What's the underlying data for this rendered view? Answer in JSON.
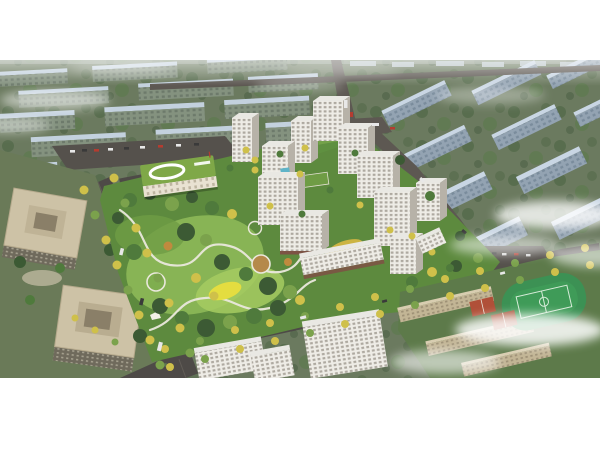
{
  "image": {
    "kind": "aerial-architectural-rendering",
    "regions": [
      "background-building-rows",
      "mist-clouds",
      "residential-tower-cluster",
      "central-park",
      "kindergarten-building",
      "office-towers",
      "school-campus",
      "sports-field",
      "tree-lined-boulevards",
      "roads"
    ]
  },
  "colors": {
    "ground": "#6b7a5f",
    "ground_dark": "#55654c",
    "bg_slab_top": "#c3d1de",
    "bg_slab_top_r": "#c9d6e4",
    "bg_slab_face": "#84927f",
    "bg_slab_face_r": "#93a3b2",
    "tree_dark": "#3c5a34",
    "tree_mid": "#4f7a3c",
    "tree_light": "#7ba24c",
    "tree_yellow": "#cfc04a",
    "tree_orange": "#c08a3e",
    "road": "#4e4a47",
    "road_light": "#5d5852",
    "path_white": "#eae8dc",
    "park_base": "#5d8a3e",
    "lawn_light": "#8db858",
    "lawn_bright": "#a6cb62",
    "feature_yellow": "#e4dd40",
    "tower_face": "#eeece6",
    "tower_side": "#b7b2a8",
    "tower_roof": "#e9e8e3",
    "tower_win": "#9d988e",
    "kg_roof": "#7fa848",
    "kg_face": "#e9e2d2",
    "office_tan": "#cdc2a6",
    "school_tan": "#c2b595",
    "field_green": "#3f9b58",
    "court_red": "#b05038",
    "pool_blue": "#5fb4c8",
    "storefront": "#7c5344",
    "mist": "#ffffff",
    "car_white": "#e8e8e8",
    "car_red": "#b43c30"
  }
}
